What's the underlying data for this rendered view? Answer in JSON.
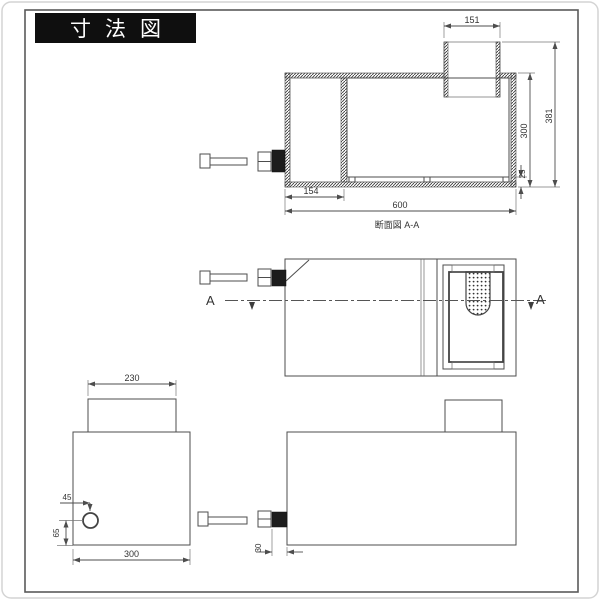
{
  "title_bar": {
    "label": "寸法図"
  },
  "section_view": {
    "caption": "断面図 A-A",
    "dim_riser_width": "151",
    "dim_total_height": "381",
    "dim_body_height": "300",
    "dim_base_gap": "25",
    "dim_inlet_offset": "154",
    "dim_total_width": "600"
  },
  "plan_view": {
    "section_label_left": "A",
    "section_label_right": "A"
  },
  "end_view": {
    "dim_lid_width": "230",
    "dim_pipe_offset_x": "45",
    "dim_pipe_offset_y": "65",
    "dim_body_width": "300"
  },
  "front_view": {
    "dim_pipe_protrusion": "30"
  },
  "colors": {
    "background": "#ffffff",
    "line": "#4d4d4d",
    "frame": "#5a5a5a",
    "title_bg": "#0f0f0f",
    "title_fg": "#ffffff"
  }
}
